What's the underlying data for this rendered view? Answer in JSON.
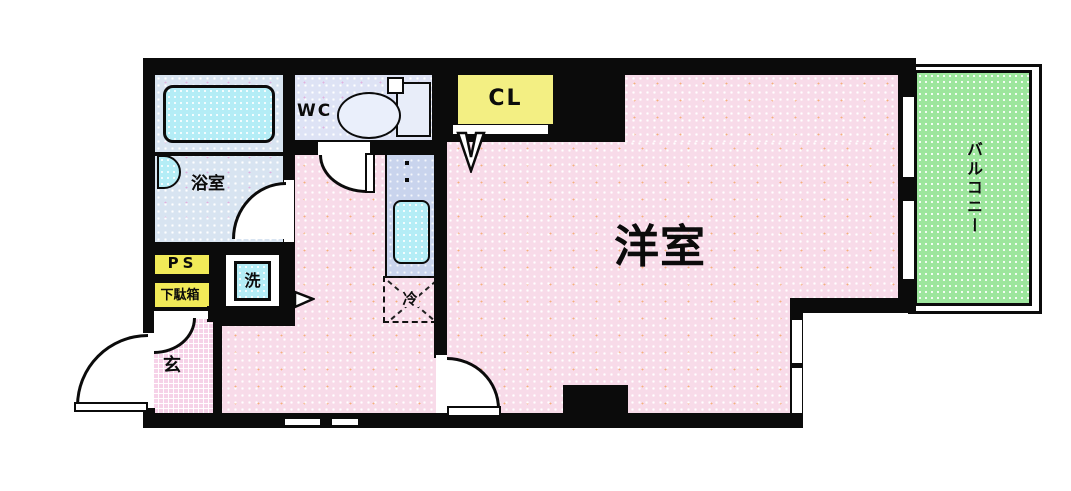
{
  "title": "apartment-floor-plan",
  "labels": {
    "main_room": "洋室",
    "balcony": "バルコニー",
    "bathroom": "浴室",
    "toilet": "WC",
    "closet": "CL",
    "pipe_space": "PS",
    "shoe_cabinet": "下駄箱",
    "washer": "洗",
    "entrance": "玄",
    "refrigerator": "冷"
  },
  "colors": {
    "wall": "#0b0b0b",
    "room_pink": "#f8dbe9",
    "entrance_pink": "#f6d2e8",
    "bathroom_blue": "#d8e4f1",
    "wc_lavender": "#dee3f5",
    "fixture_cyan": "#b4edf6",
    "kitchen_counter": "#c9d4ed",
    "closet_yellow": "#f1ea58",
    "balcony_green": "#9de69d"
  }
}
